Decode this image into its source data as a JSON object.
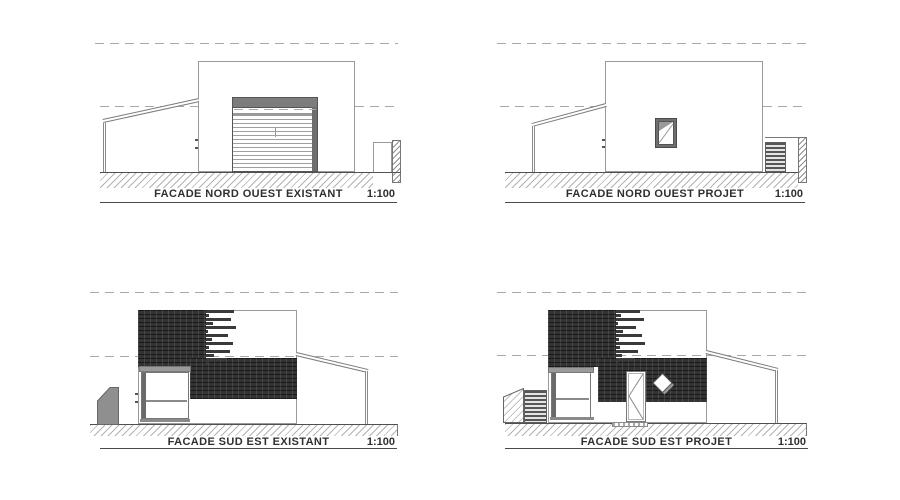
{
  "drawings": [
    {
      "title": "FACADE NORD OUEST EXISTANT",
      "scale": "1:100"
    },
    {
      "title": "FACADE NORD OUEST PROJET",
      "scale": "1:100"
    },
    {
      "title": "FACADE SUD EST EXISTANT",
      "scale": "1:100"
    },
    {
      "title": "FACADE SUD EST PROJET",
      "scale": "1:100"
    }
  ],
  "colors": {
    "paper": "#ffffff",
    "ink": "#2f2f2f",
    "outline_gray": "#9a9a9a",
    "cladding_dark": "#333333",
    "fill_gray": "#8f8f8f",
    "dash_gray": "#a8a8a8"
  }
}
